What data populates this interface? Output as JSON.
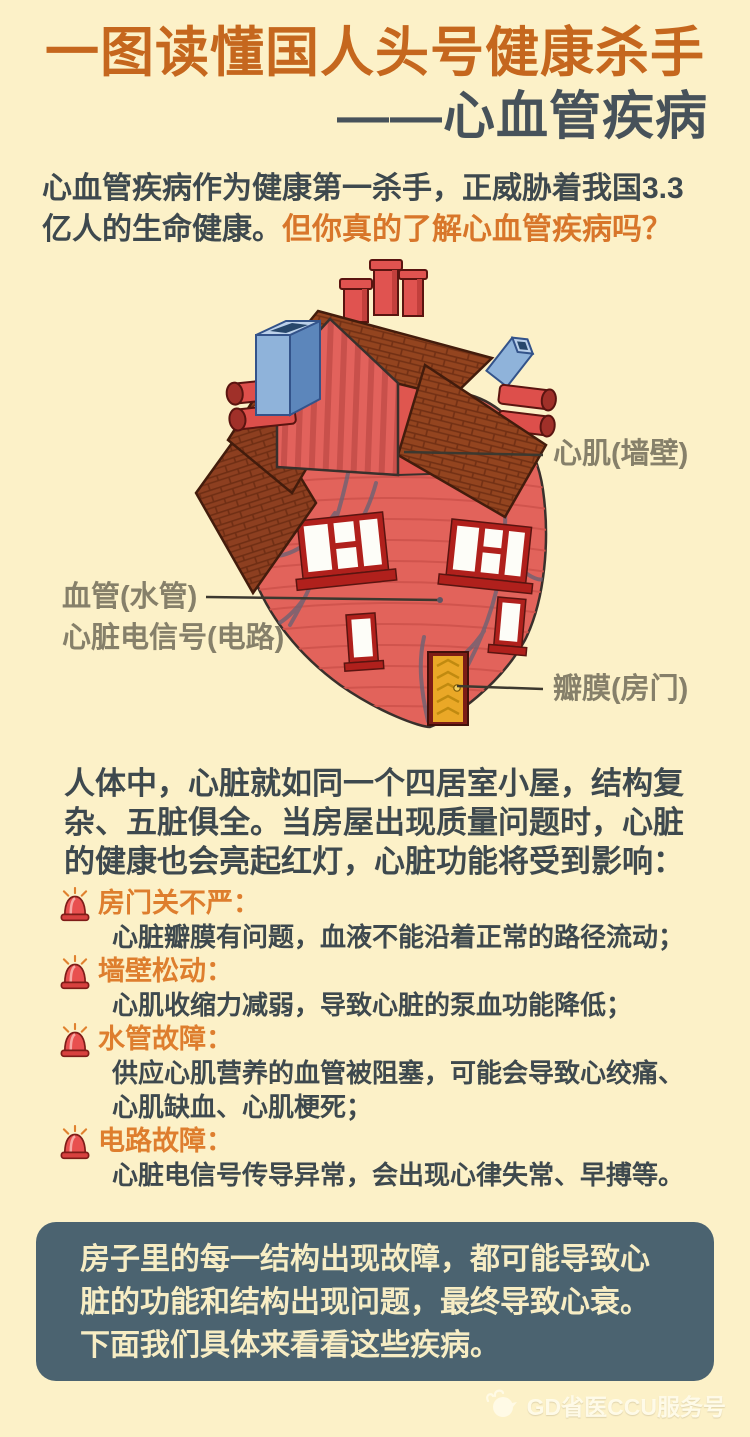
{
  "header": {
    "title_line1": "一图读懂国人头号健康杀手",
    "title_line2": "——心血管疾病"
  },
  "intro": {
    "statement": "心血管疾病作为健康第一杀手，正威胁着我国3.3亿人的生命健康。",
    "question": "但你真的了解心血管疾病吗？"
  },
  "illustration": {
    "description": "heart drawn as a house",
    "labels": {
      "myocardium": "心肌(墙壁)",
      "vessel": "血管(水管)",
      "signal": "心脏电信号(电路)",
      "valve": "瓣膜(房门)"
    }
  },
  "analogy_paragraph": "人体中，心脏就如同一个四居室小屋，结构复杂、五脏俱全。当房屋出现质量问题时，心脏的健康也会亮起红灯，心脏功能将受到影响：",
  "alerts": [
    {
      "title": "房门关不严：",
      "desc": "心脏瓣膜有问题，血液不能沿着正常的路径流动；"
    },
    {
      "title": "墙壁松动：",
      "desc": "心肌收缩力减弱，导致心脏的泵血功能降低；"
    },
    {
      "title": "水管故障：",
      "desc": "供应心肌营养的血管被阻塞，可能会导致心绞痛、心肌缺血、心肌梗死；"
    },
    {
      "title": "电路故障：",
      "desc": "心脏电信号传导异常，会出现心律失常、早搏等。"
    }
  ],
  "summary_box": "房子里的每一结构出现故障，都可能导致心脏的功能和结构出现问题，最终导致心衰。下面我们具体来看看这些疾病。",
  "watermark": "GD省医CCU服务号",
  "colors": {
    "background": "#fcf1c8",
    "title_orange": "#c5671e",
    "title_slate": "#47525a",
    "body_text": "#3e494e",
    "accent_orange": "#de7e2e",
    "heart_red": "#e2635b",
    "roof_brick": "#8d3f20",
    "chimney_blue": "#8fb3da",
    "door_yellow": "#eaa827",
    "window_frame_red": "#b0201c",
    "summary_bg": "#4b6370",
    "summary_text": "#f7edc4"
  }
}
